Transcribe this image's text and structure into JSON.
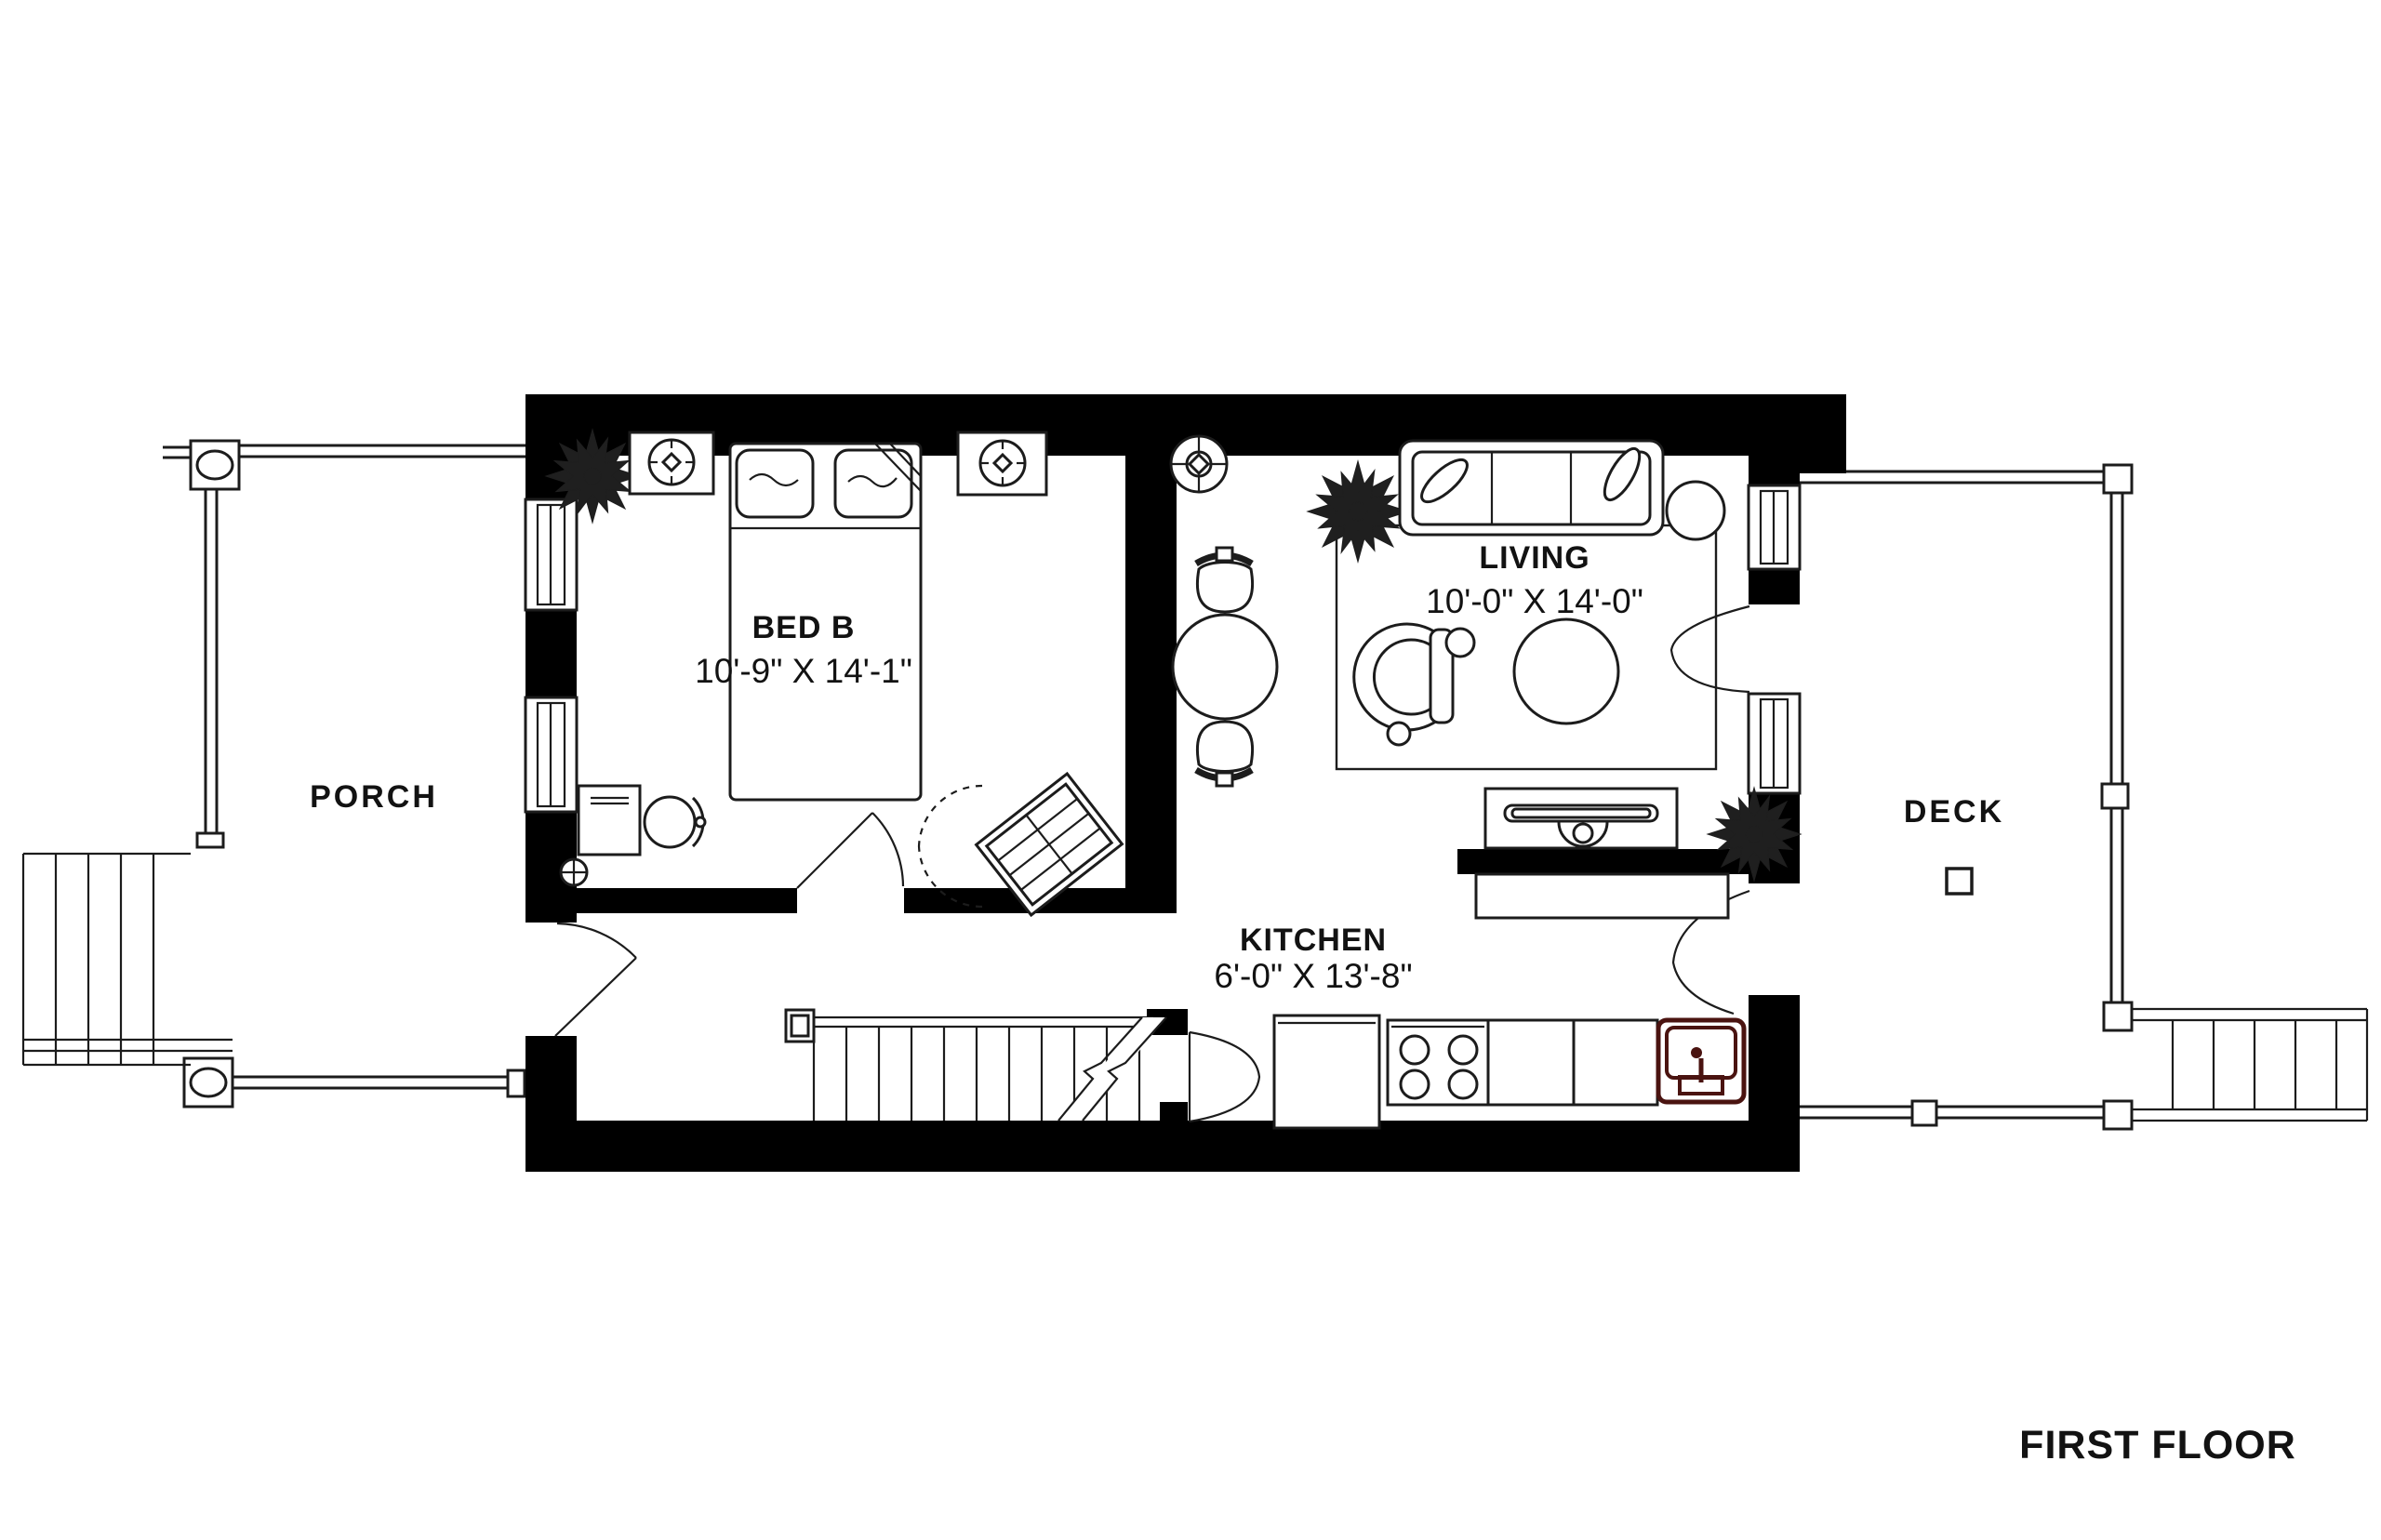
{
  "plan": {
    "title": "FIRST FLOOR",
    "rooms": {
      "porch": {
        "label": "PORCH"
      },
      "bed_b": {
        "label": "BED B",
        "dimensions": "10'-9\" X 14'-1\""
      },
      "living": {
        "label": "LIVING",
        "dimensions": "10'-0\" X 14'-0\""
      },
      "kitchen": {
        "label": "KITCHEN",
        "dimensions": "6'-0\" X 13'-8\""
      },
      "deck": {
        "label": "DECK"
      }
    },
    "colors": {
      "walls": "#000000",
      "background": "#ffffff",
      "lines": "#1c1c1c",
      "sink_accent": "#4a1310",
      "text": "#121212"
    },
    "symbols": {
      "bedroom": [
        "double-bed-icon",
        "pillow-icon",
        "nightstand-icon",
        "table-lamp-icon",
        "desk-icon",
        "desk-chair-icon",
        "plant-icon",
        "clothes-rack-icon",
        "outlet-icon"
      ],
      "living": [
        "sofa-icon",
        "throw-pillow-icon",
        "ceiling-fan-icon",
        "round-dining-table-icon",
        "dining-chair-icon",
        "armchair-icon",
        "ottoman-icon",
        "rug-icon",
        "tv-console-icon",
        "side-table-icon",
        "plant-icon"
      ],
      "kitchen": [
        "refrigerator-icon",
        "stove-icon",
        "burner-icon",
        "counter-icon",
        "sink-icon"
      ],
      "exterior": [
        "stairs-icon",
        "railing-icon",
        "post-icon",
        "door-swing-icon",
        "window-icon"
      ]
    }
  }
}
